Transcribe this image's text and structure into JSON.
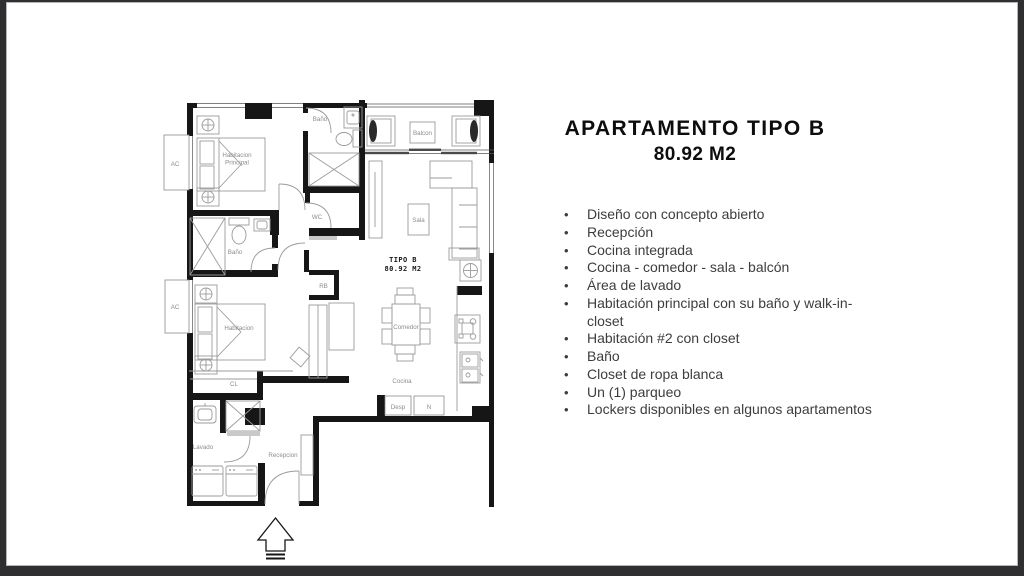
{
  "panel": {
    "title": "APARTAMENTO TIPO B",
    "subtitle": "80.92 M2",
    "bullets": [
      "Diseño con concepto abierto",
      "Recepción",
      "Cocina integrada",
      " Cocina - comedor - sala - balcón",
      "Área de lavado",
      "Habitación principal con su baño y walk-in-closet",
      "Habitación #2 con closet",
      "Baño",
      "Closet de ropa blanca",
      "Un (1) parqueo",
      "Lockers disponibles en algunos apartamentos"
    ]
  },
  "plan": {
    "title": "TIPO B",
    "area": "80.92 M2",
    "labels": {
      "ac_top": "AC",
      "ac_bottom": "AC",
      "hab_principal_1": "Habitacion",
      "hab_principal_2": "Principal",
      "bano_top": "Baño",
      "balcon": "Balcon",
      "sala": "Sala",
      "wc": "WC",
      "bano_left": "Baño",
      "rb": "RB",
      "habitacion2": "Habitacion",
      "cl": "CL",
      "comedor": "Comedor",
      "cocina": "Cocina",
      "desp": "Desp",
      "nevera": "N",
      "lavado": "Lavado",
      "recepcion": "Recepcion"
    },
    "colors": {
      "wall": "#161616",
      "furniture": "#9b9b9b",
      "label": "#8c8c8c"
    }
  },
  "frame": {
    "background": "#2f2f32",
    "slide_background": "#ffffff"
  }
}
